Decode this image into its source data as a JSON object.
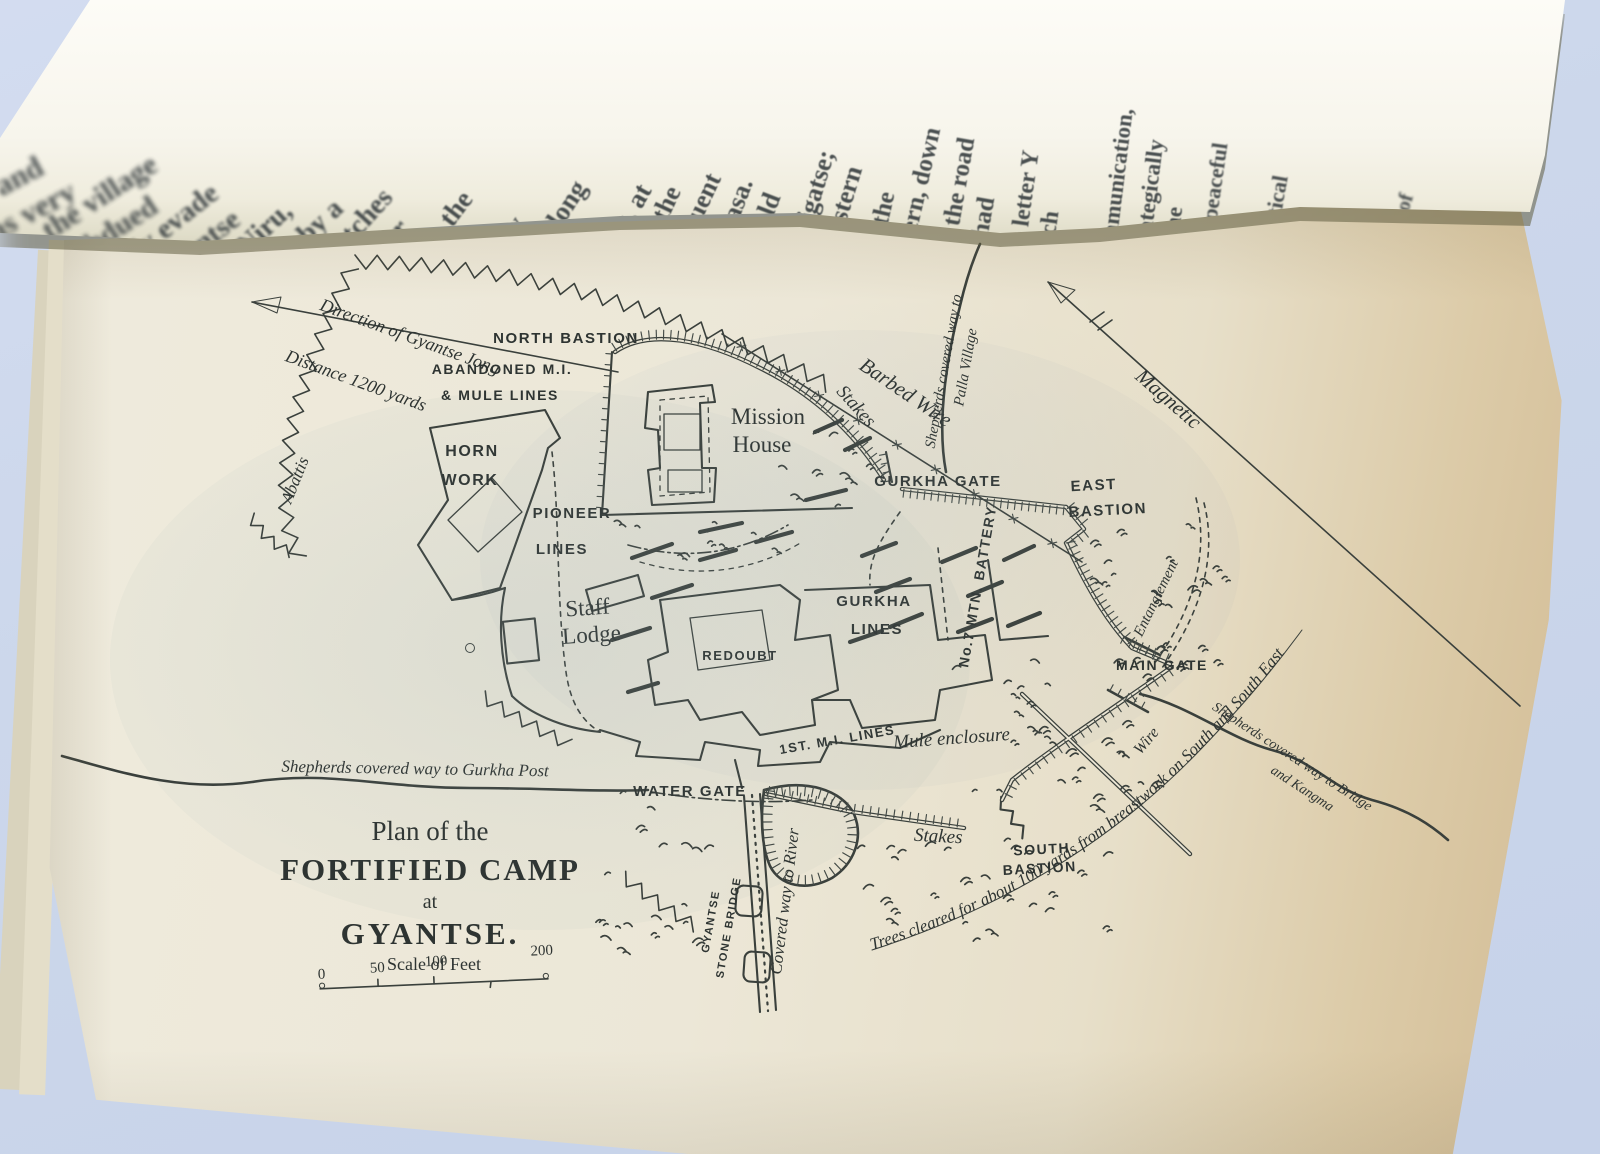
{
  "photo": {
    "background_color": "#ccd7eb",
    "page_color": "#ece7d7",
    "aged_edge_color": "#cfb98f",
    "ink_color": "#3a403c"
  },
  "overleaf": {
    "columns": [
      [
        "om and",
        "was very"
      ],
      [
        "the village",
        "subdued"
      ],
      [
        "ly evade",
        "Gyantse"
      ],
      [
        "a Niru,",
        "whereby a"
      ],
      [
        "stretches",
        "another"
      ],
      [
        "gma, the",
        "same"
      ],
      [
        "thirty",
        "miles along"
      ],
      [
        "from",
        "Ralung, at"
      ],
      [
        "clear the",
        "subsequent"
      ],
      [
        "to Lhasa.",
        "It should"
      ],
      [
        "to Shigatse;",
        "the eastern"
      ],
      [
        "abi; the",
        "western, down"
      ],
      [
        "g is the road",
        "we had"
      ],
      [
        "the letter Y",
        "much"
      ],
      [
        "of",
        "communication,"
      ],
      [
        "strategically",
        "at the"
      ],
      [
        "the peaceful",
        "and"
      ],
      [
        "political",
        "and"
      ],
      [
        "the",
        "best"
      ],
      [
        "als of",
        "the"
      ]
    ]
  },
  "map": {
    "title": {
      "line1": "Plan of the",
      "line2": "FORTIFIED CAMP",
      "line3": "at",
      "line4": "GYANTSE."
    },
    "scale": {
      "label": "Scale of Feet",
      "ticks": [
        "0",
        "50",
        "100",
        "200"
      ]
    },
    "labels": {
      "north_bastion": "NORTH BASTION",
      "abandoned_1": "ABANDONED M.I.",
      "abandoned_2": "& MULE LINES",
      "mission_1": "Mission",
      "mission_2": "House",
      "horn_1": "HORN",
      "horn_2": "WORK",
      "pioneer_1": "PIONEER",
      "pioneer_2": "LINES",
      "staff_1": "Staff",
      "staff_2": "Lodge",
      "redoubt": "REDOUBT",
      "gurkha_lines_1": "GURKHA",
      "gurkha_lines_2": "LINES",
      "gurkha_gate": "GURKHA GATE",
      "east_1": "EAST",
      "east_2": "BASTION",
      "mtn_battery": "No.7 MTN. BATTERY",
      "entanglement": "Entanglement",
      "main_gate": "MAIN GATE",
      "first_mi": "1ST. M.I. LINES",
      "mule": "Mule enclosure",
      "wire": "Wire",
      "water_gate": "WATER GATE",
      "covered_river": "Covered way to River",
      "stone_bridge_1": "GYANTSE",
      "stone_bridge_2": "STONE BRIDGE",
      "stakes_ne": "Stakes",
      "stakes_s": "Stakes",
      "south_1": "SOUTH",
      "south_2": "BASTION",
      "barbed": "Barbed Wire",
      "magnetic": "Magnetic",
      "abattis": "Abattis",
      "direction_1": "Direction of Gyantse Jong",
      "direction_2": "Distance 1200 yards",
      "trees": "Trees cleared for about 100 yards from breastwork on South and South East",
      "shep_palla_1": "Shepherds covered way to",
      "shep_palla_2": "Palla Village",
      "shep_gurkha": "Shepherds covered way to Gurkha Post",
      "shep_bridge_1": "Shepherds covered way to Bridge",
      "shep_bridge_2": "and Kangma"
    }
  }
}
